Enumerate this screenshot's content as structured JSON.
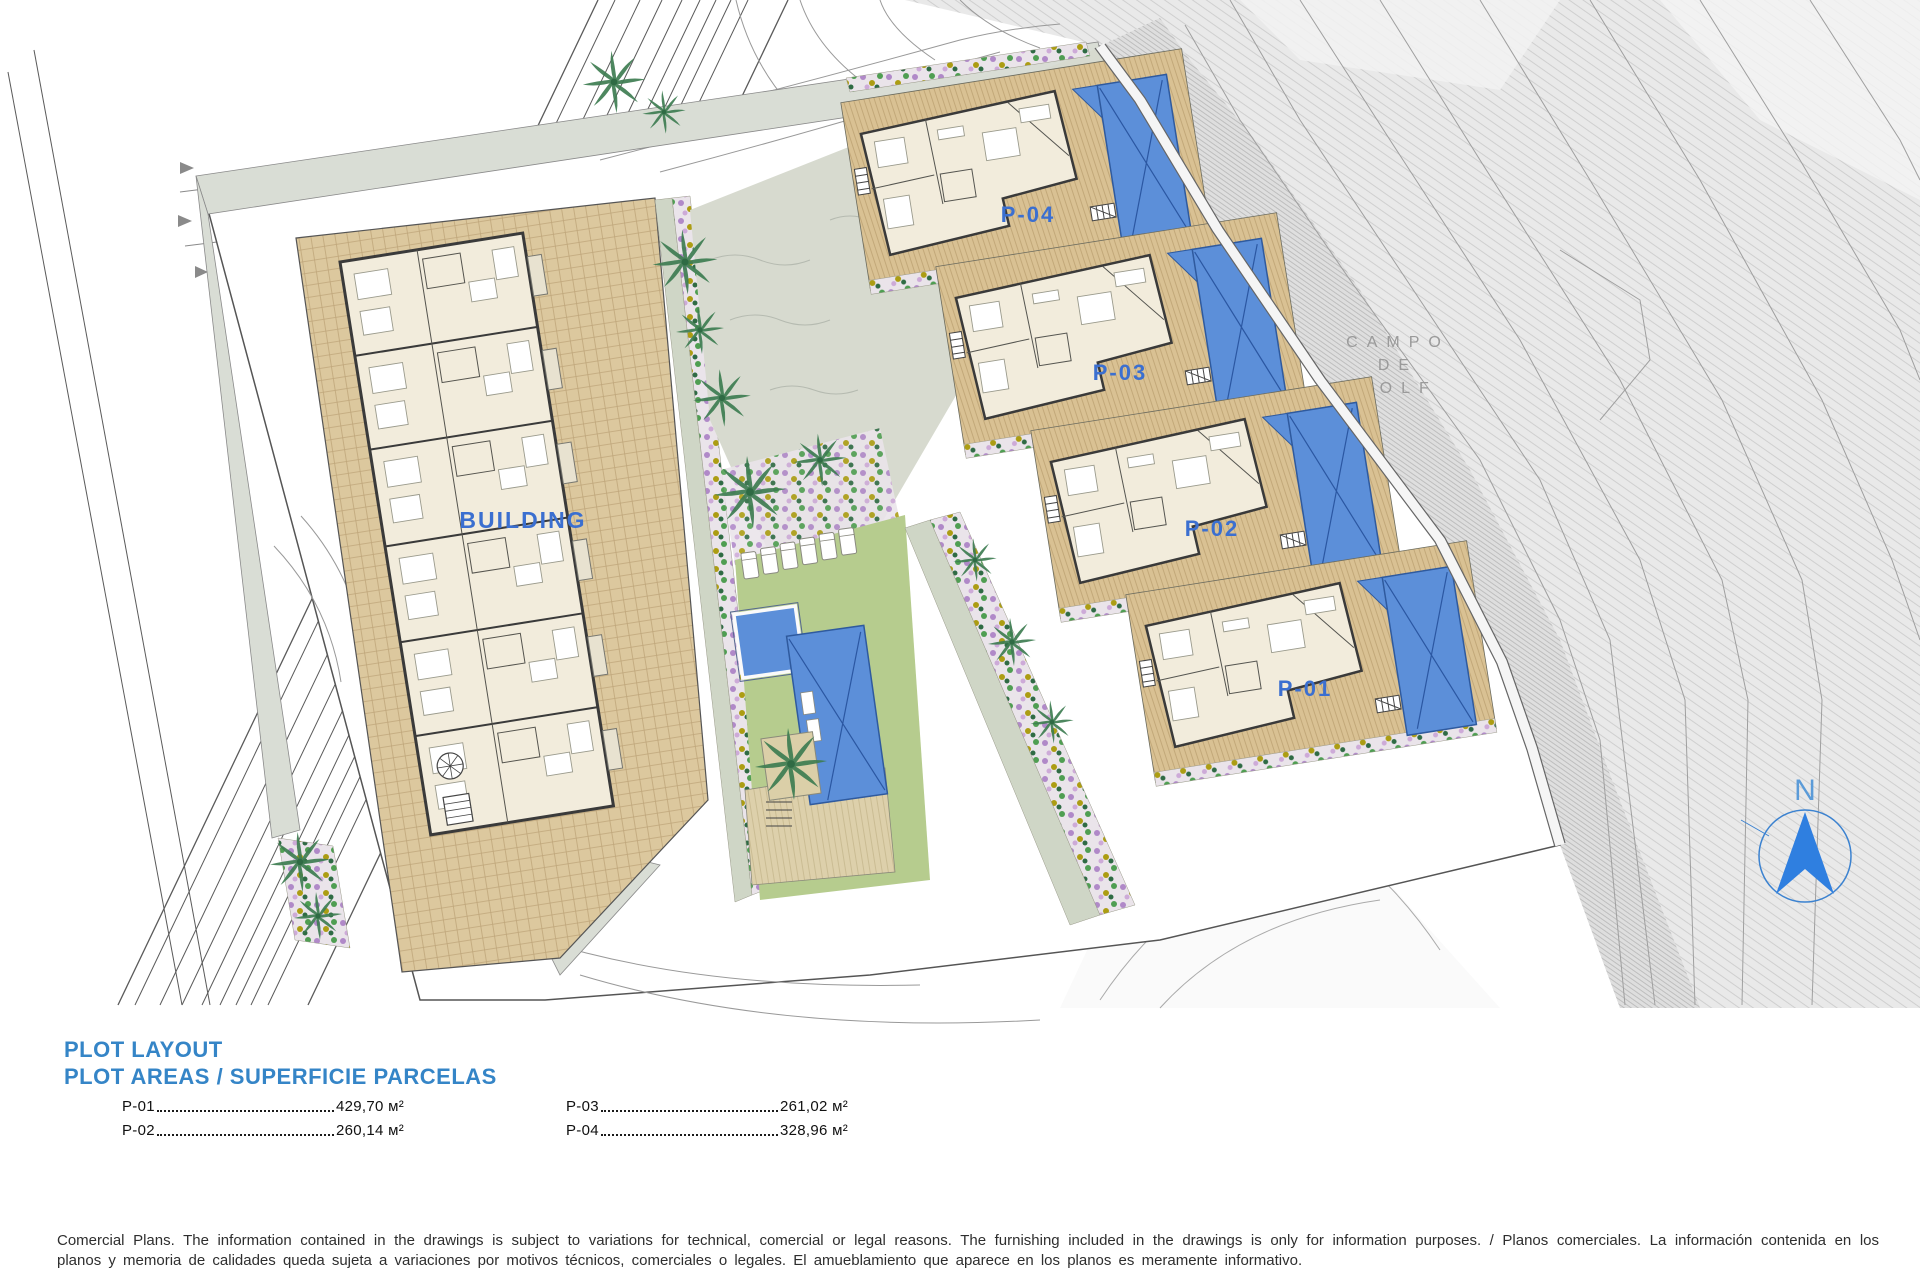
{
  "plan": {
    "building_label": "BUILDING",
    "plots": [
      {
        "id": "P-01",
        "area": "429,70 м²"
      },
      {
        "id": "P-02",
        "area": "260,14 м²"
      },
      {
        "id": "P-03",
        "area": "261,02 м²"
      },
      {
        "id": "P-04",
        "area": "328,96 м²"
      }
    ],
    "golf_label": {
      "line1": "CAMPO",
      "line2": "DE",
      "line3": "GOLF"
    },
    "north_label": "N"
  },
  "legend": {
    "title_line1": "PLOT LAYOUT",
    "title_line2": "PLOT AREAS / SUPERFICIE PARCELAS"
  },
  "disclaimer": "Comercial Plans. The information contained in the drawings is subject to variations for technical, comercial or legal reasons. The furnishing included in the drawings is only for information purposes. / Planos comerciales. La información contenida en los planos y memoria de calidades queda sujeta a variaciones por motivos técnicos, comerciales o legales. El amueblamiento que aparece en los planos es meramente informativo.",
  "colors": {
    "accent_blue": "#3b6fd0",
    "pool_blue": "#5c8fd9",
    "lawn_green": "#b6cc8e",
    "paving_tan": "#dcc89e",
    "golf_gray": "#e9e9e9"
  }
}
